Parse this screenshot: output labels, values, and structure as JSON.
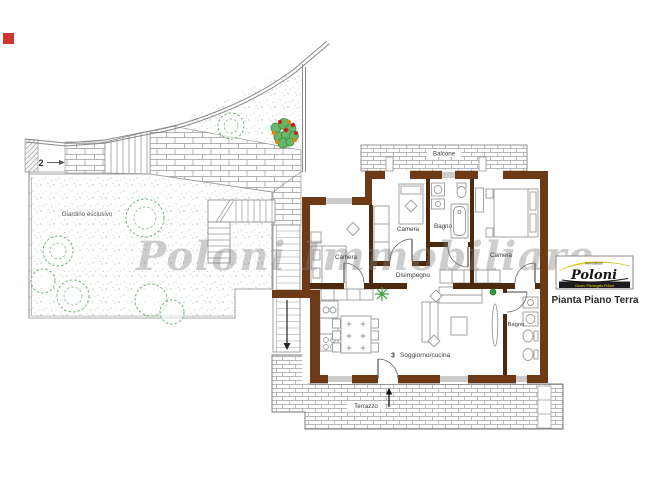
{
  "watermark": "Poloni Immobiliare",
  "marker2": "2",
  "garden_label": "Giardino esclusivo",
  "rooms": {
    "balcone": "Balcone",
    "camera_left": "Camera",
    "camera_mid": "Camera",
    "bagno_top": "Bagno",
    "camera_right": "Camera",
    "disimpegno": "Disimpegno",
    "soggiorno_number": "3",
    "soggiorno": "Soggiorno/cucina",
    "bagno_lower": "Bagno",
    "terrazzo": "Terrazzo"
  },
  "logo": {
    "brand": "Poloni",
    "tagline": "Immobiliare",
    "subtext": "Geom. Pierangelo Poloni",
    "caption": "Pianta Piano Terra"
  },
  "colors": {
    "exterior_wall": "#6e3a15",
    "interior_wall": "#4d2a0e",
    "brick_line": "#a3a3a3",
    "tree_green": "#72b072",
    "accent_red": "#d0342c",
    "logo_yellow": "#f5d915"
  }
}
